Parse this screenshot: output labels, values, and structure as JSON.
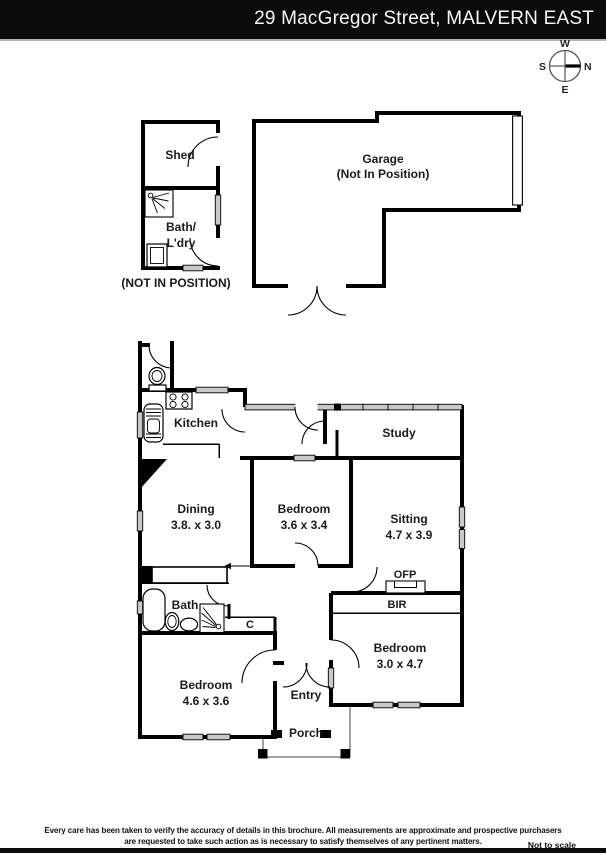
{
  "header": {
    "title": "29 MacGregor Street, MALVERN EAST"
  },
  "compass": {
    "west": "W",
    "north": "N",
    "south": "S",
    "east": "E"
  },
  "outbuilding": {
    "shed": "Shed",
    "bath_line1": "Bath/",
    "bath_line2": "L'dry",
    "note": "(NOT IN POSITION)"
  },
  "garage": {
    "label": "Garage",
    "note": "(Not In Position)"
  },
  "rooms": {
    "kitchen": "Kitchen",
    "dining": {
      "name": "Dining",
      "dims": "3.8. x 3.0"
    },
    "bedroom_mid": {
      "name": "Bedroom",
      "dims": "3.6 x 3.4"
    },
    "study": "Study",
    "sitting": {
      "name": "Sitting",
      "dims": "4.7 x 3.9"
    },
    "ofp": "OFP",
    "bir": "BIR",
    "bedroom_right": {
      "name": "Bedroom",
      "dims": "3.0 x 4.7"
    },
    "bedroom_left": {
      "name": "Bedroom",
      "dims": "4.6 x 3.6"
    },
    "bath": "Bath",
    "closet": "C",
    "entry": "Entry",
    "porch": "Porch"
  },
  "footer": {
    "line1": "Every care has been taken to verify the accuracy of details in this brochure.  All measurements are approximate and prospective purchasers",
    "line2": "are requested to take such action as is necessary to satisfy themselves of any pertinent matters.",
    "note": "Not to scale"
  },
  "colors": {
    "wall": "#000000",
    "window": "#c9c9c9",
    "header_bg": "#0b0b0b"
  }
}
